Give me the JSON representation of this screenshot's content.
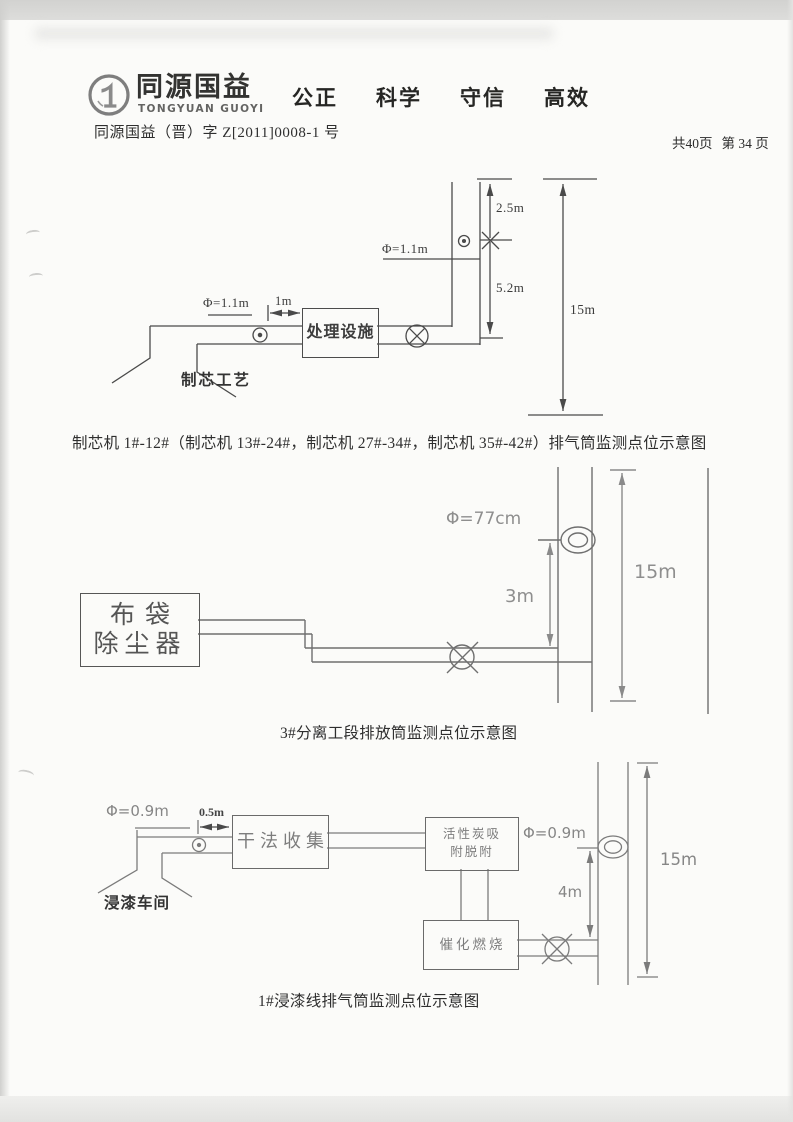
{
  "colors": {
    "ink": "#2f2f2f",
    "cad_gray": "#8e8e8e",
    "line_dark": "#4a4a4a",
    "line_mid": "#6f6f6f",
    "line_light": "#7b7b7b"
  },
  "header": {
    "logo_cn": "同源国益",
    "logo_en": "TONGYUAN GUOYI",
    "slogans": [
      "公正",
      "科学",
      "守信",
      "高效"
    ],
    "doc_number": "同源国益（晋）字 Z[2011]0008-1 号",
    "page_total": "共40页",
    "page_current": "第 34 页"
  },
  "diagram1": {
    "caption": "制芯机 1#-12#（制芯机 13#-24#，制芯机 27#-34#，制芯机 35#-42#）排气筒监测点位示意图",
    "stack_diameter": "Φ=1.1m",
    "inlet_diameter": "Φ=1.1m",
    "inlet_distance": "1m",
    "upper_section_height": "2.5m",
    "lower_section_height": "5.2m",
    "stack_height": "15m",
    "treatment_box": "处理设施",
    "source": "制芯工艺"
  },
  "diagram2": {
    "caption": "3#分离工段排放筒监测点位示意图",
    "collector_line1": "布袋",
    "collector_line2": "除尘器",
    "stack_diameter": "Φ=77cm",
    "port_height": "3m",
    "stack_height": "15m"
  },
  "diagram3": {
    "caption": "1#浸漆线排气筒监测点位示意图",
    "inlet_diameter": "Φ=0.9m",
    "inlet_distance": "0.5m",
    "source": "浸漆车间",
    "box_dry": "干法收集",
    "box_carbon_line1": "活性炭吸",
    "box_carbon_line2": "附脱附",
    "stack_diameter": "Φ=0.9m",
    "port_height": "4m",
    "box_catalytic": "催化燃烧",
    "stack_height": "15m"
  }
}
